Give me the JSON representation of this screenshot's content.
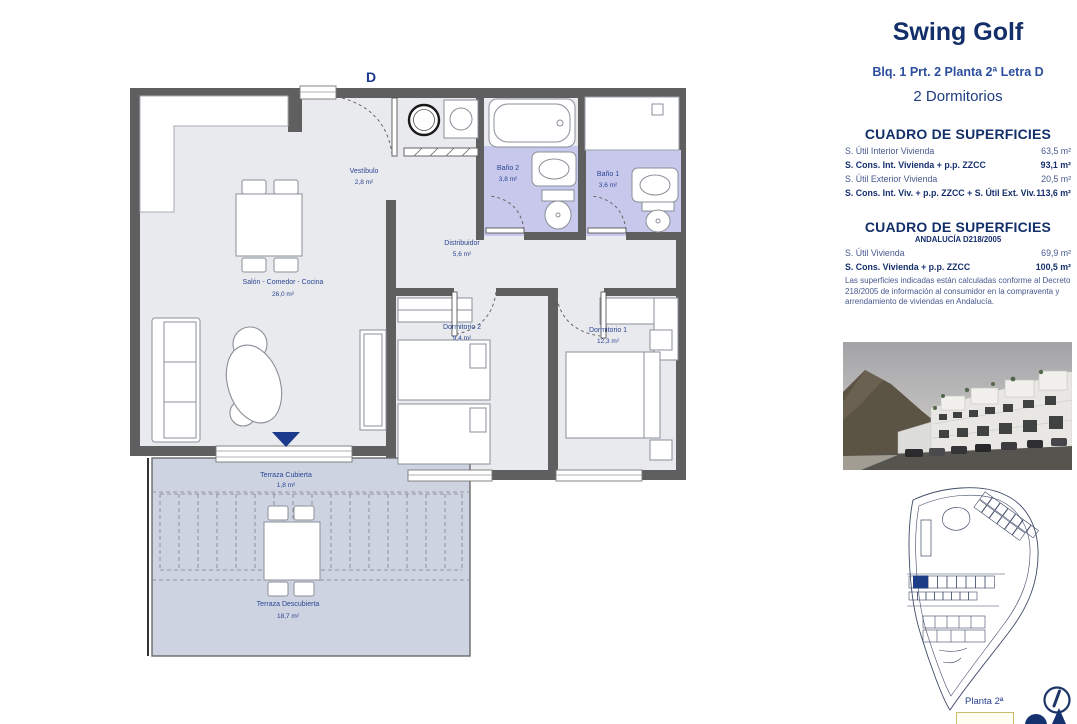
{
  "header": {
    "title": "Swing Golf",
    "subtitle": "Blq. 1 Prt. 2 Planta 2ª Letra D",
    "bedrooms": "2 Dormitorios"
  },
  "surfaces_table": {
    "title": "CUADRO DE SUPERFICIES",
    "rows": [
      {
        "label": "S. Útil Interior Vivienda",
        "value": "63,5 m²"
      },
      {
        "label": "S. Cons. Int. Vivienda + p.p. ZZCC",
        "value": "93,1 m²"
      },
      {
        "label": "S. Útil Exterior Vivienda",
        "value": "20,5 m²"
      },
      {
        "label": "S. Cons. Int. Viv. + p.p. ZZCC + S. Útil Ext. Viv.",
        "value": "113,6 m²"
      }
    ]
  },
  "andalucia_table": {
    "title": "CUADRO DE SUPERFICIES",
    "subtitle": "ANDALUCÍA D218/2005",
    "rows": [
      {
        "label": "S. Útil Vivienda",
        "value": "69,9 m²"
      },
      {
        "label": "S. Cons. Vivienda + p.p. ZZCC",
        "value": "100,5 m²"
      }
    ],
    "disclaimer": "Las superficies indicadas están calculadas conforme al Decreto 218/2005 de información al consumidor en la compraventa y arrendamiento de viviendas en Andalucía."
  },
  "floorplan": {
    "entry_label": "D",
    "rooms": {
      "vestibulo": {
        "name": "Vestíbulo",
        "area": "2,8 m²"
      },
      "salon": {
        "name": "Salón - Comedor - Cocina",
        "area": "26,0 m²"
      },
      "bano2": {
        "name": "Baño 2",
        "area": "3,8 m²"
      },
      "bano1": {
        "name": "Baño 1",
        "area": "3,6 m²"
      },
      "distribuidor": {
        "name": "Distribuidor",
        "area": "5,6 m²"
      },
      "dormitorio2": {
        "name": "Dormitorio 2",
        "area": "9,4 m²"
      },
      "dormitorio1": {
        "name": "Dormitorio 1",
        "area": "12,3 m²"
      },
      "terraza_cubierta": {
        "name": "Terraza Cubierta",
        "area": "1,8 m²"
      },
      "terraza_descubierta": {
        "name": "Terraza Descubierta",
        "area": "18,7 m²"
      }
    }
  },
  "site_plan": {
    "floor_label": "Planta 2ª"
  },
  "colors": {
    "navy_title": "#132f69",
    "navy_text": "#2c4694",
    "wall_gray": "#5f5f5f",
    "floor_gray": "#e9eaee",
    "bath_lavender": "#c7c8eb",
    "terrace_blue": "#cdd3e1",
    "highlight_unit": "#1c3c85"
  }
}
